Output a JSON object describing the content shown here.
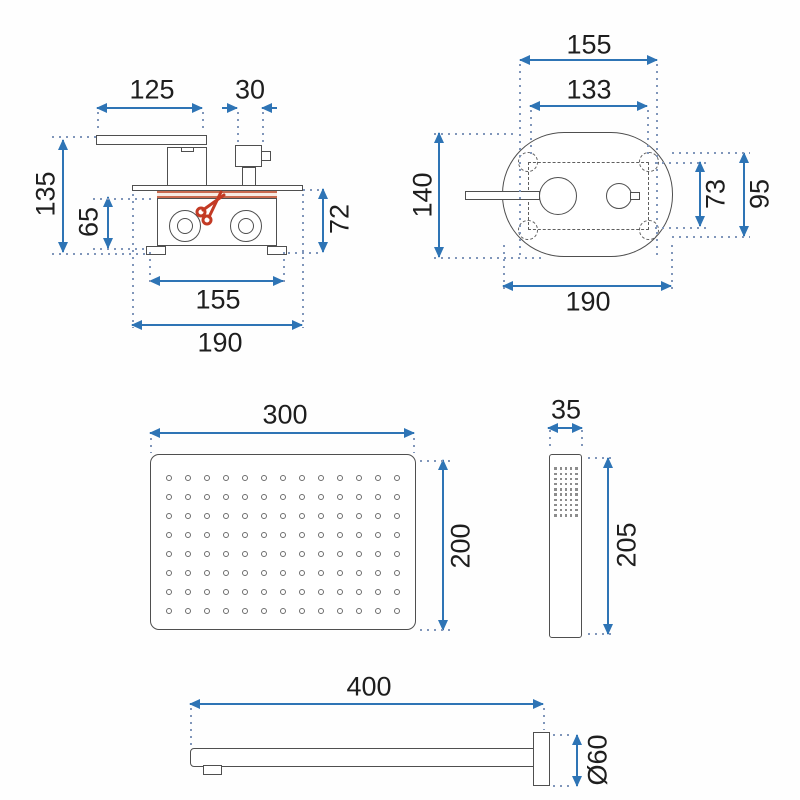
{
  "colors": {
    "dimension_blue": "#2e74b5",
    "dotted_blue": "#8096ba",
    "outline_gray": "#4f4f4f",
    "cut_red": "#c33a24",
    "band_red": "#c96a50",
    "text": "#1e1e1e",
    "background": "#fefefe"
  },
  "mixer_side_view": {
    "dim_spout_length": "125",
    "dim_knob_width": "30",
    "dim_total_height": "135",
    "dim_box_height": "65",
    "dim_right_height": "72",
    "dim_box_width": "155",
    "dim_plate_width": "190",
    "cut_icon": "scissors"
  },
  "faceplate_front_view": {
    "dim_top_outer_width": "155",
    "dim_top_inner_width": "133",
    "dim_plate_height": "140",
    "dim_right_inner_height": "73",
    "dim_right_outer_height": "95",
    "dim_plate_width": "190"
  },
  "shower_head_view": {
    "dim_width": "300",
    "dim_height": "200",
    "nozzle_grid": {
      "rows": 8,
      "cols": 13
    }
  },
  "hand_shower_view": {
    "dim_width": "35",
    "dim_height": "205",
    "nozzle_grid": {
      "rows": 10,
      "cols": 5
    }
  },
  "wall_arm_view": {
    "dim_length": "400",
    "dim_flange_diameter": "Ø60"
  }
}
